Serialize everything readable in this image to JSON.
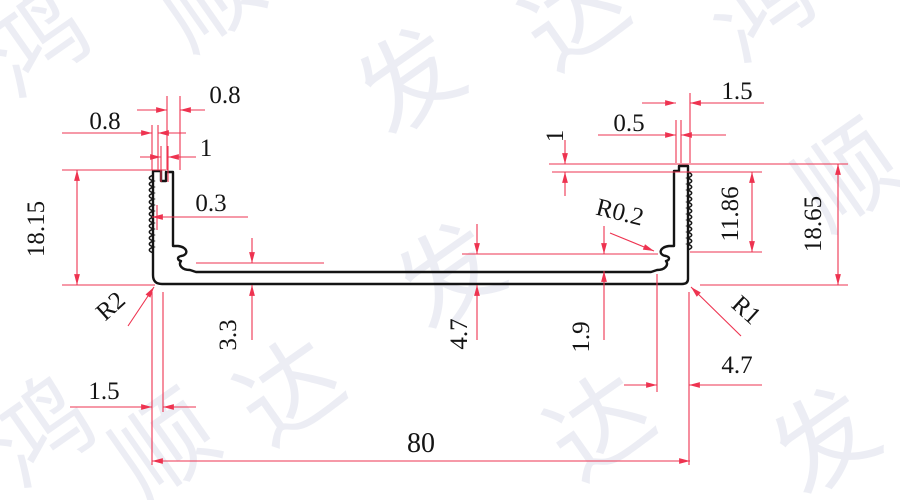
{
  "watermark": {
    "chars": [
      "鸿",
      "顺",
      "发",
      "达"
    ]
  },
  "dims": {
    "top_left_a": "0.8",
    "top_left_b": "0.8",
    "top_left_c": "1",
    "tooth": "0.3",
    "left_height": "18.15",
    "r2": "R2",
    "boss": "3.3",
    "mid": "4.7",
    "inner": "1.9",
    "r02": "R0.2",
    "right_offset": "1",
    "lip": "0.5",
    "wall": "1.5",
    "knurl": "11.86",
    "right_height": "18.65",
    "r1": "R1",
    "right_step": "4.7",
    "bottom_thk": "1.5",
    "width": "80"
  },
  "colors": {
    "dimension": "#ee3350",
    "outline": "#141414",
    "watermark": "#aab1cf"
  }
}
